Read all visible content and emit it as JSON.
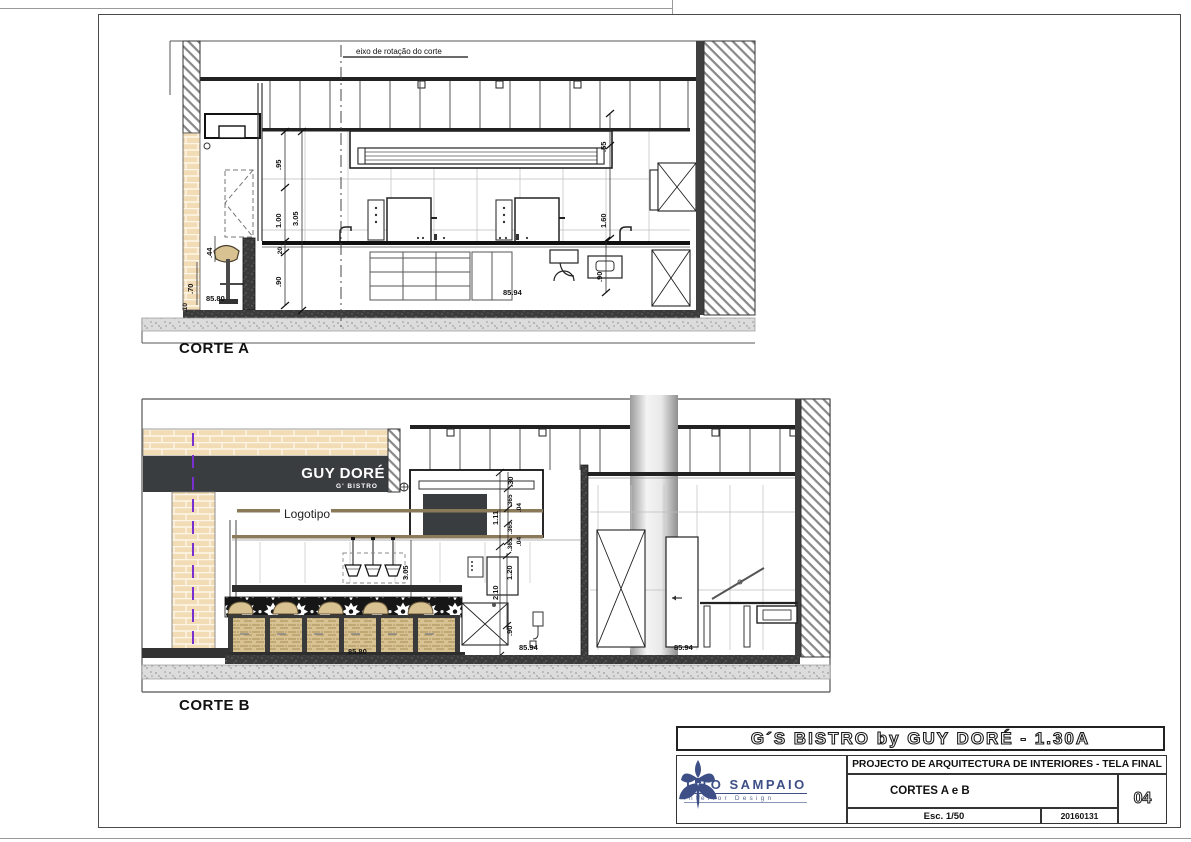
{
  "sheet": {
    "banner": "G´S BISTRO by GUY DORÉ  -  1.30A",
    "project": "PROJECTO DE ARQUITECTURA DE INTERIORES  -  TELA FINAL",
    "drawing_title": "CORTES A e B",
    "scale": "Esc. 1/50",
    "date": "20160131",
    "number": "04",
    "logo_name": "TITO SAMPAIO",
    "logo_sub": "Interior Design"
  },
  "corte_a": {
    "label": "CORTE A",
    "axis_label": "eixo de rotação do corte",
    "dims": {
      "h095": ".95",
      "h100": "1.00",
      "h305": "3.05",
      "h020": ".20",
      "h090": ".90",
      "w044": ".44",
      "w070": ".70",
      "w010": ".10",
      "r055": ".55",
      "r160": "1.60",
      "r090": ".90"
    },
    "levels": {
      "left": "85.80",
      "mid": "85.94"
    }
  },
  "corte_b": {
    "label": "CORTE B",
    "sign_main": "GUY DORÉ",
    "sign_sub": "G' BISTRO",
    "callout": "Logotipo",
    "dims": {
      "d030": ".30",
      "d365a": ".365",
      "d365b": ".365",
      "d111": "1.11",
      "d04a": ".04",
      "d365c": ".365",
      "d04b": ".04",
      "d120": "1.20",
      "d210": "2.10",
      "d090": ".90",
      "d305": "3.05"
    },
    "levels": {
      "bar": "85.80",
      "mid": "85.94",
      "right": "85.94"
    }
  },
  "colors": {
    "brick": "#f2dcb6",
    "sign_bg": "#3a3d40",
    "axis_purple": "#7a2fd0",
    "logo_blue": "#3d4f86",
    "wood": "#8a7a5a",
    "rattan": "#d8c291"
  }
}
